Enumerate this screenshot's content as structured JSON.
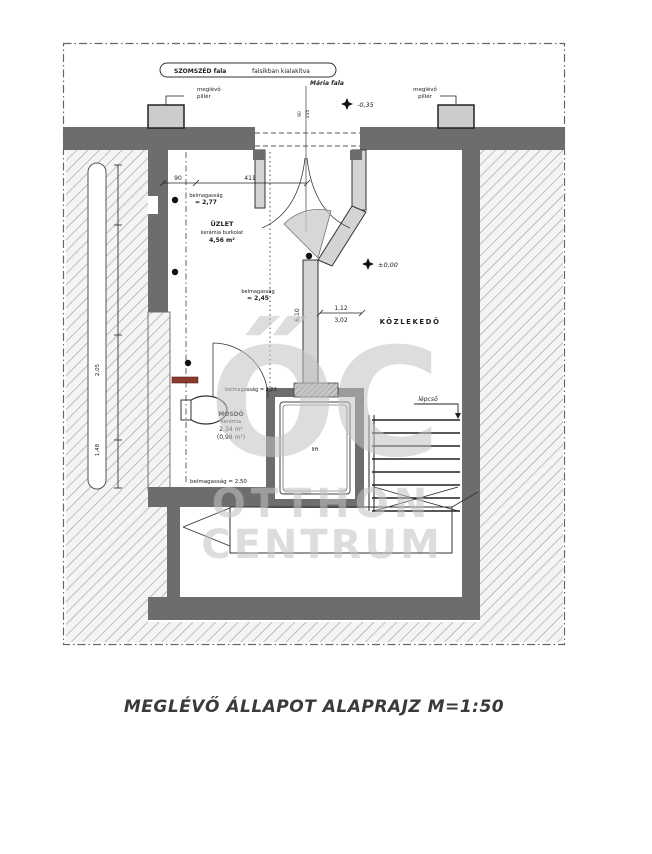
{
  "caption": "MEGLÉVŐ ÁLLAPOT ALAPRAJZ M=1:50",
  "watermark": {
    "logo": "ŐC",
    "line1": "OTTHON",
    "line2": "CENTRUM"
  },
  "banner": {
    "left": "SZOMSZÉD fala",
    "right": "falsíkban kialakítva"
  },
  "labels": {
    "maria": "Mária fala",
    "pillar_line1": "meglévő",
    "pillar_line2": "pillér",
    "stairs": "lépcső",
    "lift": "lift",
    "kozlekedo": "KÖZLEKEDŐ",
    "height_word": "belmagasság",
    "bottom_height": "belmagasság = 2,50",
    "wc_height": "belmagasság = 2,03"
  },
  "levels": {
    "entrance": "-0,35",
    "corridor": "±0,00",
    "uzlet_h": "= 2,77",
    "mid_h": "= 2,45"
  },
  "rooms": {
    "uzlet": {
      "name": "ÜZLET",
      "finish": "kerámia burkolat",
      "area": "4,56 m²"
    },
    "mosdo": {
      "name": "MOSDÓ",
      "finish": "kerámia",
      "area": "2,34 m²",
      "area2": "(0,98 m²)"
    }
  },
  "dims": {
    "d90": "90",
    "d411": "411",
    "d112": "1,12",
    "d302": "3,02",
    "d610": "6,10",
    "open_w": "90",
    "open_h": "215",
    "side_a": "2,05",
    "side_b": "1,48"
  }
}
